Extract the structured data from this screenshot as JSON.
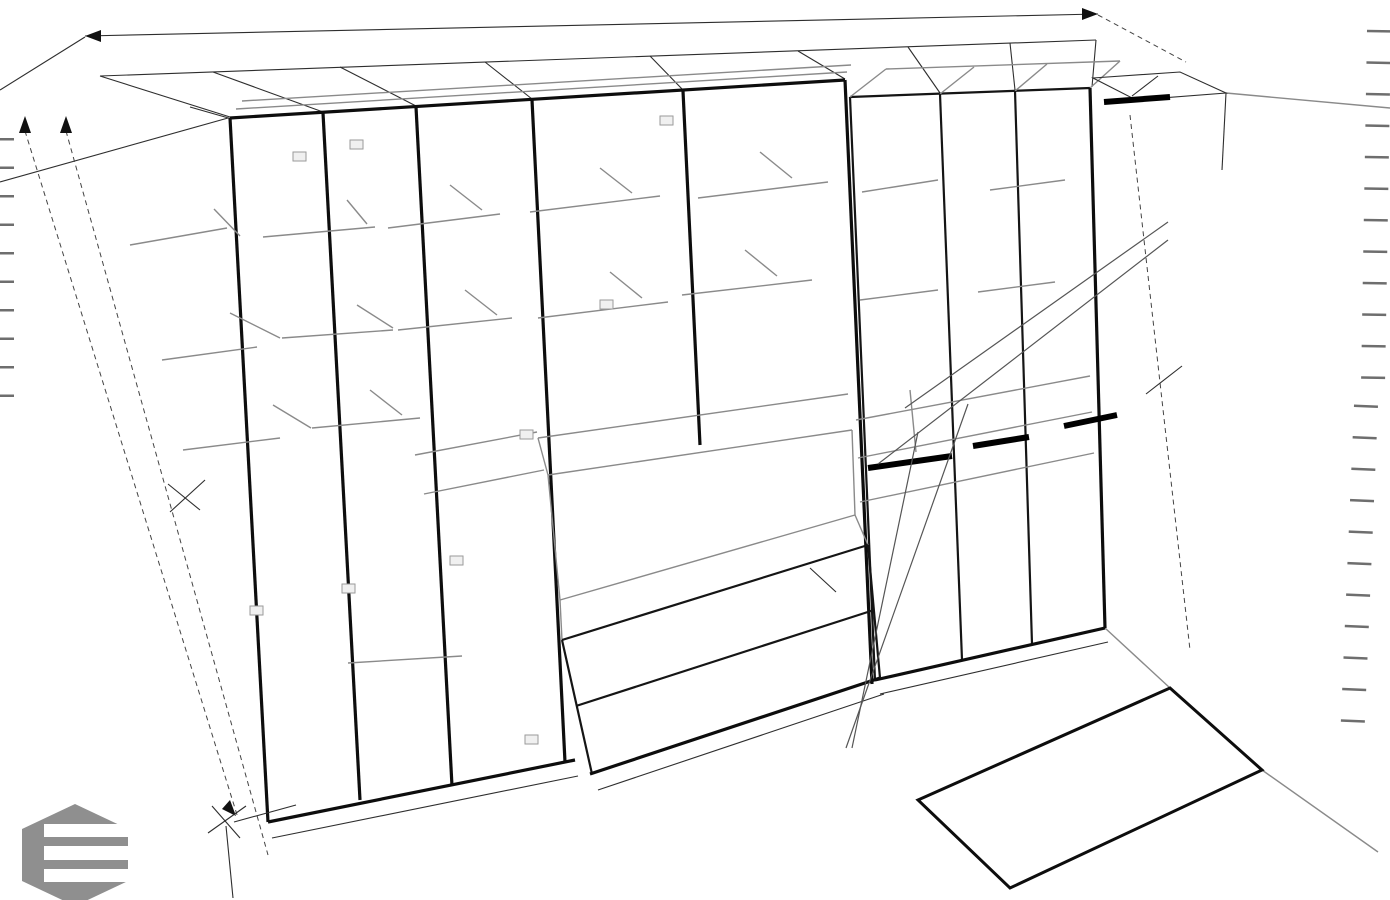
{
  "colors": {
    "background": "#ffffff",
    "ink": "#1b1b1b",
    "line_gray": "#8a8a8a",
    "faint_text": "#b9b9b9",
    "logo_gray": "#8f8f8f"
  },
  "dimensions": {
    "total_width": "4200",
    "segments": [
      "400",
      "400",
      "500",
      "650",
      "650",
      "600",
      "500",
      "500"
    ],
    "left_height": "2860",
    "left_lower_height": "1400",
    "right_height": "1400",
    "tv_niche_width": "1300",
    "ghost_width": "500",
    "ghost_depth": "600",
    "drawer_height_1": "270",
    "drawer_height_2": "270",
    "rod_section_1": "300",
    "rod_section_2": "300",
    "floor_panel_length": "1500",
    "floor_panel_depth": "600"
  },
  "top_left": {
    "gap_word": "зазор",
    "gap_value": "5 мм",
    "to_ceiling": "до потолка",
    "facade_depth": "350 с фасадом"
  },
  "top_right": {
    "depth": "600",
    "depth_note": "гл с фасадом",
    "rod": "штанга"
  },
  "shelves": {
    "perf1": "полка с перф",
    "perf2": "50 мм",
    "perfar1": "полка с перфар",
    "perfar2": "50мм",
    "tip_on": "tip-on",
    "h250": "н250",
    "h250_spaced": "н 250",
    "plain": "полка",
    "per1": "полка",
    "per2": "пер",
    "s_per": "полка с пер",
    "rod": "штанга",
    "depth350_1": "350",
    "depth350_2": "гл",
    "no_ins1": "без вклад",
    "no_ins2": "полок",
    "quad_box": "квадро бокс",
    "tv_back1": "лдсп задняя стенка",
    "tv_back2": "ТВ",
    "depth600": "гл 600"
  },
  "annotations": {
    "back_wall": [
      "задняя стенка",
      "в открытой полке",
      "лдсп -гл 350"
    ],
    "open_shelf": [
      "открытая полка",
      "гл 350-в уровень фасада",
      "18мм",
      "кромка в цвет по",
      "периметру"
    ],
    "plinth": [
      "цоколь 18",
      "гл цоколя по глубине корпуса"
    ],
    "floor_panel": [
      "ЛДСП эгер бежевый",
      "песок / в тон фасада"
    ]
  },
  "logo": {
    "text": "VO"
  }
}
